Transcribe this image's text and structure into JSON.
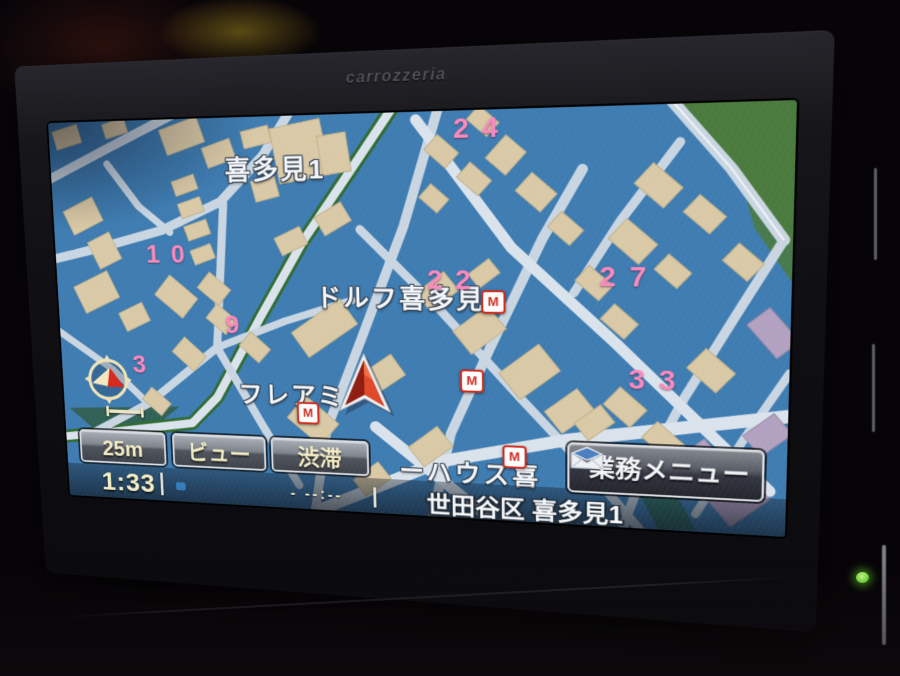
{
  "theme": {
    "map_bg": "#3e7cb1",
    "road": "#c9d6e2",
    "road_major": "#dae3ec",
    "building": "#d9c9a6",
    "building_edge": "#c2b189",
    "park": "#4a7a3d",
    "tree_line": "#2f6b33",
    "lavender": "#b2a1c0",
    "teal_zone": "#2d6b5c",
    "pink_number": "#f98abd",
    "label_text": "#f3f6fa",
    "button_text": "#f2ecc4",
    "poi_red": "#cf2b1d",
    "arrow_red": "#d43a1f",
    "led_green": "#7de63d"
  },
  "device": {
    "brand": "carrozzeria"
  },
  "map": {
    "district_label": "喜多見1",
    "labels": [
      {
        "text": "ドルフ喜多見"
      },
      {
        "text": "フレアミ"
      },
      {
        "text": "ーハウス喜"
      }
    ],
    "block_numbers": [
      {
        "text": "24"
      },
      {
        "text": "10"
      },
      {
        "text": "9"
      },
      {
        "text": "3"
      },
      {
        "text": "22"
      },
      {
        "text": "27"
      },
      {
        "text": "33"
      }
    ],
    "poi_m_label": "M"
  },
  "toolbar": {
    "scale_button": "25m",
    "view_button": "ビュー",
    "traffic_button": "渋滞"
  },
  "menu_button": {
    "label": "業務メニュー"
  },
  "status_bar": {
    "clock": "1:33",
    "eta_placeholder": "- --:--",
    "address": "世田谷区 喜多見1"
  }
}
